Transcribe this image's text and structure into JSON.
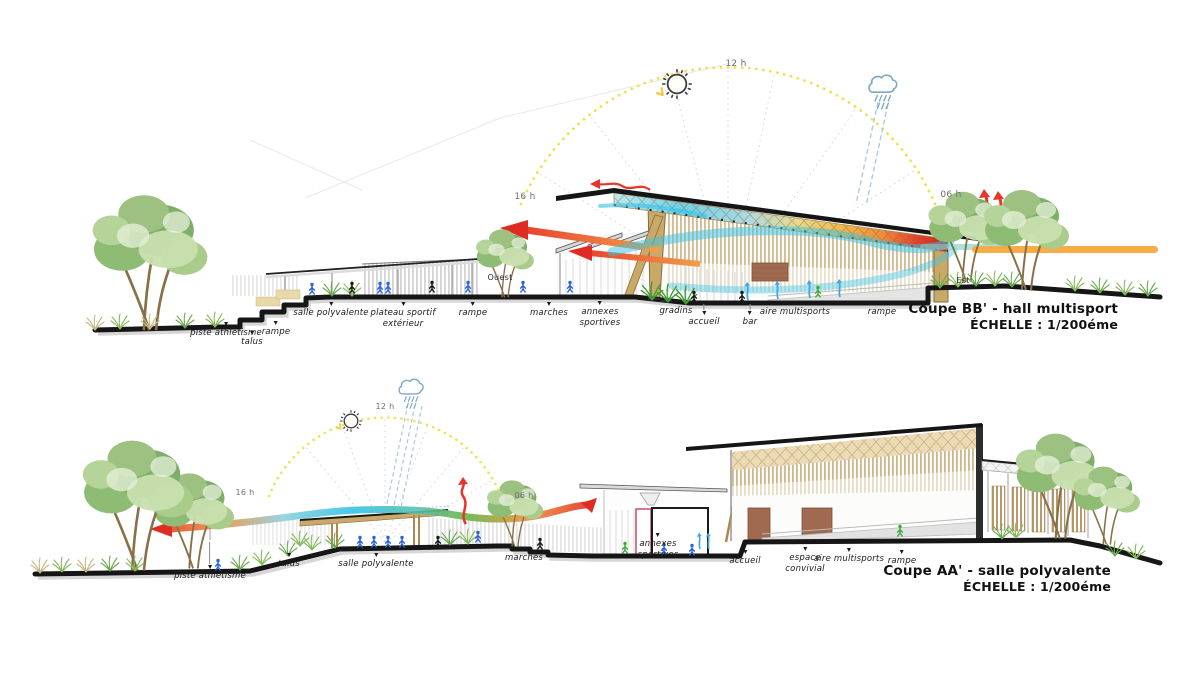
{
  "sections": {
    "bb": {
      "title": "Coupe BB' - hall multisport",
      "scale": "ÉCHELLE : 1/200éme",
      "west_label": "Ouest",
      "east_label": "Est",
      "time_afternoon": "16 h",
      "time_noon": "12 h",
      "time_morning": "06 h",
      "annotations": [
        "piste athlétisme",
        "talus",
        "rampe",
        "salle polyvalente",
        "plateau sportif\nextérieur",
        "rampe",
        "marches",
        "annexes\nsportives",
        "gradins",
        "accueil",
        "bar",
        "aire multisports",
        "rampe"
      ]
    },
    "aa": {
      "title": "Coupe AA' - salle polyvalente",
      "scale": "ÉCHELLE : 1/200éme",
      "time_afternoon": "16 h",
      "time_noon": "12 h",
      "time_morning": "06 h",
      "annotations": [
        "piste athlétisme",
        "talus",
        "salle polyvalente",
        "marches",
        "annexes\nsportives",
        "accueil",
        "espace\nconvivial",
        "aire multisports",
        "rampe"
      ]
    }
  },
  "icons": {
    "sun": "sun-icon",
    "rain_cloud": "rain-cloud-icon"
  },
  "colors": {
    "sun_path_yellow": "#f2df52",
    "cool_air_cyan": "#35c3e8",
    "warm_air_red": "#e8342a",
    "morning_ray_orange": "#f5a93c",
    "wood_tan": "#c9a968",
    "ground_black": "#1a1a1a",
    "vegetation_green": "#7fae6a"
  }
}
